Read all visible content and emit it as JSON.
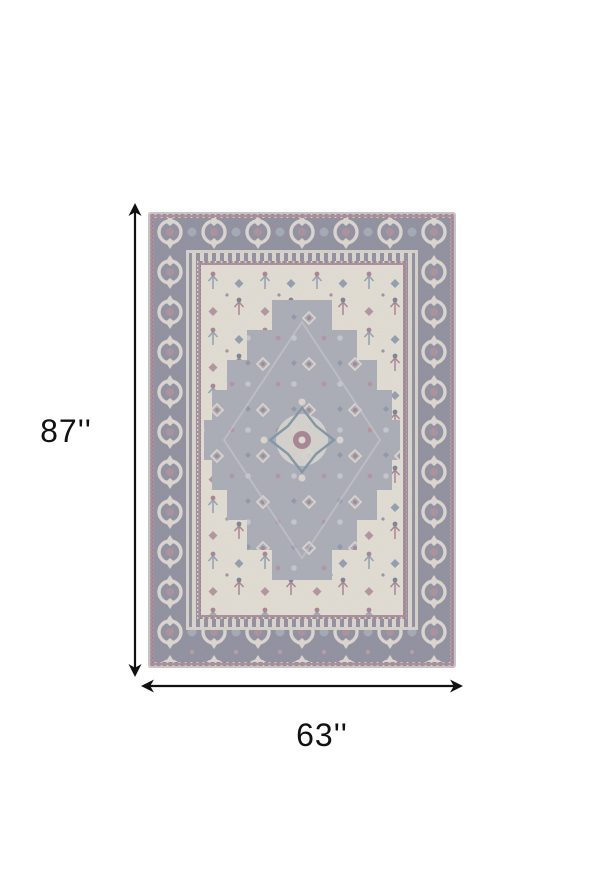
{
  "page": {
    "background_color": "#ffffff"
  },
  "product_image": {
    "alt": "Gray and ivory vintage oriental medallion area rug",
    "colors": {
      "outer_edge": "#cac6c8",
      "border_gray": "#8e8d9d",
      "guard_mauve": "#a88b95",
      "guard_cream": "#d8d3ca",
      "field_ivory": "#e5e0d4",
      "medallion_gray": "#a9abb5",
      "accent_mauve": "#a9808d",
      "accent_blue": "#8fa3b0"
    }
  },
  "dimensions": {
    "annotation_color": "#111111",
    "height": {
      "label": "87''"
    },
    "width": {
      "label": "63''"
    }
  }
}
